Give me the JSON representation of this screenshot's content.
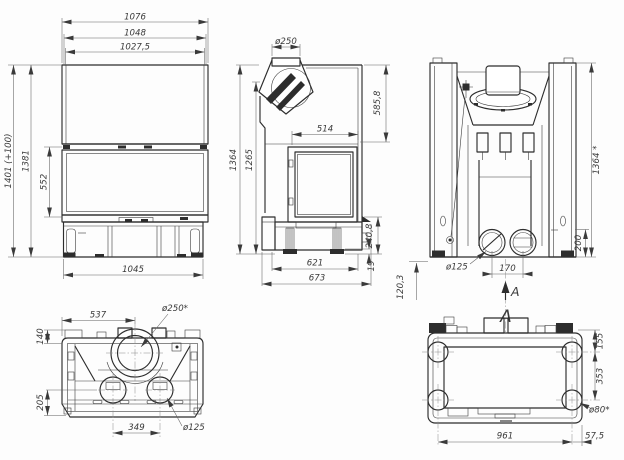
{
  "views": {
    "front": {
      "dims": {
        "width_top": "1076",
        "width_mid": "1048",
        "width_inner": "1027,5",
        "height_total": "1401 (+100)",
        "height_inner": "1381",
        "door_height": "552",
        "base_width": "1045"
      }
    },
    "side": {
      "dims": {
        "flue_diameter": "ø250",
        "top_to_door": "585,8",
        "door_depth": "514",
        "height_total": "1364",
        "height_front": "1265",
        "base_height": "240,8",
        "foot_height": "19",
        "base_depth": "621",
        "total_depth": "673"
      }
    },
    "rear": {
      "dims": {
        "height_total": "1364 *",
        "outlet_height": "200",
        "outlet_diameter": "ø125",
        "outlet_spacing": "170",
        "floor_offset": "120,3"
      },
      "section_arrow_label": "A"
    },
    "top": {
      "dims": {
        "flue_center_offset": "537",
        "flue_diameter": "ø250*",
        "front_offset": "140",
        "rear_offset": "205",
        "outlet_spacing": "349",
        "outlet_diameter": "ø125"
      }
    },
    "bottom": {
      "view_label": "A",
      "dims": {
        "edge_to_foot": "155",
        "foot_spacing_depth": "353",
        "foot_diameter": "ø80*",
        "foot_spacing_width": "961",
        "foot_edge_offset": "57,5"
      }
    }
  }
}
